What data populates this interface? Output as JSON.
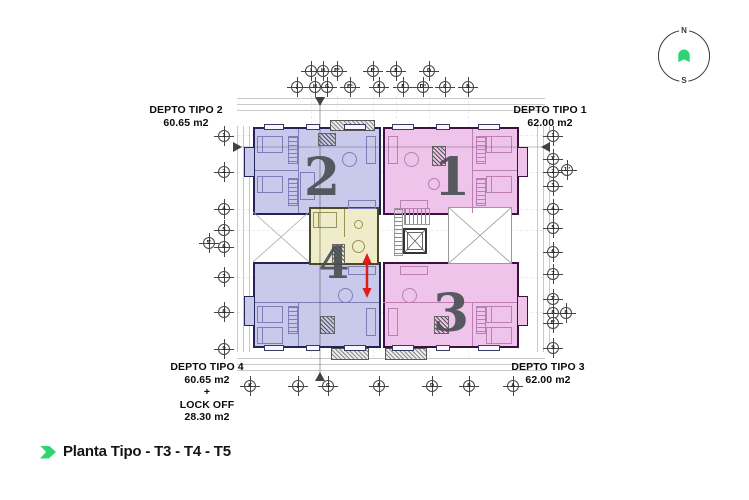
{
  "colors": {
    "accent_green": "#2ed573",
    "unit_blue_fill": "#c9c9ec",
    "unit_blue_wall": "#24245a",
    "unit_pink_fill": "#eec4ea",
    "unit_pink_wall": "#3c1040",
    "lockoff_fill": "#efecc9",
    "lockoff_wall": "#4a4a28",
    "arrow_red": "#e01b1b",
    "number_gray": "#4b5055"
  },
  "compass": {
    "north_label": "N",
    "south_label": "S"
  },
  "footer": {
    "title": "Planta Tipo - T3 - T4 - T5"
  },
  "apartments": [
    {
      "key": "tipo2",
      "name": "DEPTO TIPO 2",
      "area": "60.65 m2",
      "number": "2"
    },
    {
      "key": "tipo1",
      "name": "DEPTO TIPO 1",
      "area": "62.00 m2",
      "number": "1"
    },
    {
      "key": "tipo4",
      "name": "DEPTO TIPO 4",
      "area": "60.65 m2",
      "plus": "+",
      "lockoff_name": "LOCK OFF",
      "lockoff_area": "28.30 m2",
      "number": "4"
    },
    {
      "key": "tipo3",
      "name": "DEPTO TIPO 3",
      "area": "62.00 m2",
      "number": "3"
    }
  ],
  "grid_bubbles": [
    {
      "label": "I",
      "x": 311,
      "y": 71
    },
    {
      "label": "H",
      "x": 323,
      "y": 71
    },
    {
      "label": "F°",
      "x": 337,
      "y": 71
    },
    {
      "label": "F'",
      "x": 373,
      "y": 71
    },
    {
      "label": "E",
      "x": 396,
      "y": 71
    },
    {
      "label": "D",
      "x": 429,
      "y": 71
    },
    {
      "label": "J",
      "x": 297,
      "y": 87
    },
    {
      "label": "H",
      "x": 315,
      "y": 87
    },
    {
      "label": "G",
      "x": 327,
      "y": 87
    },
    {
      "label": "F°",
      "x": 350,
      "y": 87
    },
    {
      "label": "F",
      "x": 379,
      "y": 87
    },
    {
      "label": "E",
      "x": 403,
      "y": 87
    },
    {
      "label": "D°",
      "x": 423,
      "y": 87
    },
    {
      "label": "C",
      "x": 445,
      "y": 87
    },
    {
      "label": "B",
      "x": 468,
      "y": 87
    },
    {
      "label": "1",
      "x": 224,
      "y": 136
    },
    {
      "label": "2",
      "x": 224,
      "y": 172
    },
    {
      "label": "4",
      "x": 224,
      "y": 209
    },
    {
      "label": "5",
      "x": 224,
      "y": 230
    },
    {
      "label": "5'",
      "x": 209,
      "y": 243
    },
    {
      "label": "6",
      "x": 224,
      "y": 247
    },
    {
      "label": "7",
      "x": 224,
      "y": 277
    },
    {
      "label": "8",
      "x": 224,
      "y": 312
    },
    {
      "label": "9",
      "x": 224,
      "y": 349
    },
    {
      "label": "1",
      "x": 553,
      "y": 136
    },
    {
      "label": "1'",
      "x": 553,
      "y": 159
    },
    {
      "label": "1''",
      "x": 567,
      "y": 170
    },
    {
      "label": "2",
      "x": 553,
      "y": 172
    },
    {
      "label": "3",
      "x": 553,
      "y": 186
    },
    {
      "label": "4",
      "x": 553,
      "y": 209
    },
    {
      "label": "5",
      "x": 553,
      "y": 228
    },
    {
      "label": "6",
      "x": 553,
      "y": 252
    },
    {
      "label": "7",
      "x": 553,
      "y": 274
    },
    {
      "label": "7'",
      "x": 553,
      "y": 299
    },
    {
      "label": "8",
      "x": 553,
      "y": 313
    },
    {
      "label": "8",
      "x": 566,
      "y": 313
    },
    {
      "label": "8'",
      "x": 553,
      "y": 323
    },
    {
      "label": "9",
      "x": 553,
      "y": 348
    },
    {
      "label": "K",
      "x": 250,
      "y": 386
    },
    {
      "label": "J",
      "x": 298,
      "y": 386
    },
    {
      "label": "G",
      "x": 328,
      "y": 386
    },
    {
      "label": "F",
      "x": 379,
      "y": 386
    },
    {
      "label": "D",
      "x": 432,
      "y": 386
    },
    {
      "label": "B",
      "x": 469,
      "y": 386
    },
    {
      "label": "A",
      "x": 513,
      "y": 386
    }
  ]
}
